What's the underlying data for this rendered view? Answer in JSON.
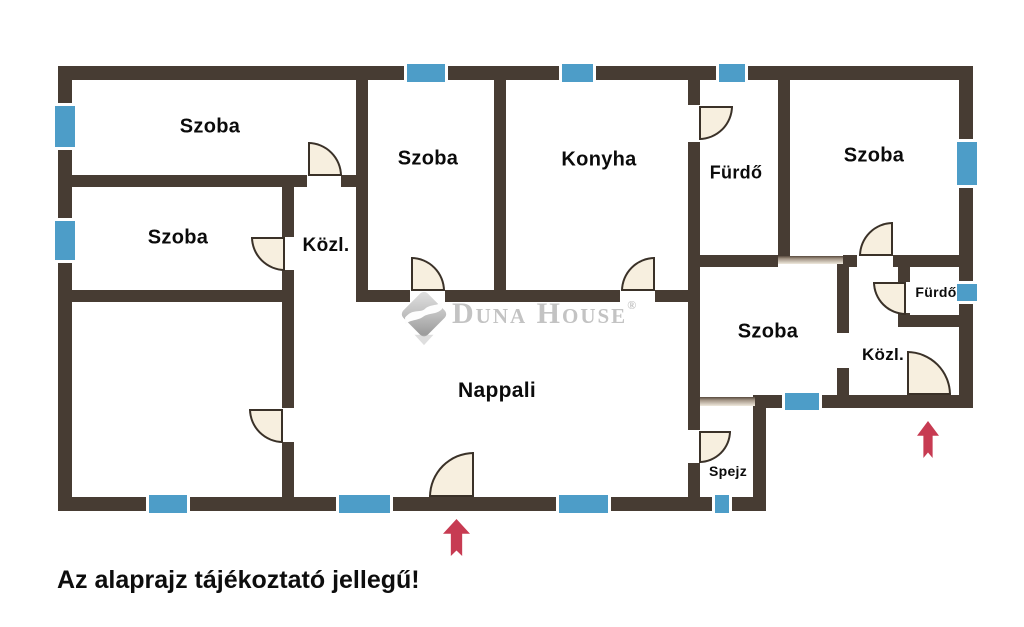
{
  "disclaimer": "Az alaprajz tájékoztató jellegű!",
  "watermark": {
    "brand": "Duna House",
    "reg": "®"
  },
  "colors": {
    "wall": "#473c33",
    "window_blue": "#4d9dc8",
    "window_frame": "#ffffff",
    "door_fill": "#f7efdf",
    "door_stroke": "#3a3128",
    "entrance_arrow": "#c73b52",
    "label_text": "#0b0b0b",
    "watermark_gray": "#c3c3c3"
  },
  "plan": {
    "rooms": [
      {
        "id": "szoba-1",
        "label": "Szoba",
        "x": 210,
        "y": 127,
        "size": 20
      },
      {
        "id": "szoba-2",
        "label": "Szoba",
        "x": 178,
        "y": 238,
        "size": 20
      },
      {
        "id": "kozl-1",
        "label": "Közl.",
        "x": 326,
        "y": 246,
        "size": 19
      },
      {
        "id": "szoba-3",
        "label": "Szoba",
        "x": 428,
        "y": 159,
        "size": 20
      },
      {
        "id": "konyha",
        "label": "Konyha",
        "x": 599,
        "y": 160,
        "size": 20
      },
      {
        "id": "furdo-1",
        "label": "Fürdő",
        "x": 736,
        "y": 173,
        "size": 18
      },
      {
        "id": "szoba-4",
        "label": "Szoba",
        "x": 874,
        "y": 156,
        "size": 20
      },
      {
        "id": "szoba-5",
        "label": "Szoba",
        "x": 768,
        "y": 332,
        "size": 20
      },
      {
        "id": "furdo-2",
        "label": "Fürdő",
        "x": 936,
        "y": 292,
        "size": 14
      },
      {
        "id": "kozl-2",
        "label": "Közl.",
        "x": 883,
        "y": 355,
        "size": 17
      },
      {
        "id": "spejz",
        "label": "Spejz",
        "x": 728,
        "y": 471,
        "size": 14
      },
      {
        "id": "nappali",
        "label": "Nappali",
        "x": 497,
        "y": 391,
        "size": 21
      }
    ],
    "walls": [
      [
        58,
        66,
        915,
        14
      ],
      [
        58,
        66,
        14,
        445
      ],
      [
        58,
        497,
        708,
        14
      ],
      [
        753,
        395,
        13,
        116
      ],
      [
        753,
        395,
        220,
        13
      ],
      [
        959,
        66,
        14,
        342
      ],
      [
        356,
        80,
        12,
        222
      ],
      [
        282,
        175,
        12,
        62
      ],
      [
        282,
        270,
        12,
        32
      ],
      [
        282,
        292,
        12,
        116
      ],
      [
        282,
        442,
        12,
        55
      ],
      [
        494,
        80,
        12,
        222
      ],
      [
        688,
        80,
        12,
        25
      ],
      [
        688,
        142,
        12,
        288
      ],
      [
        688,
        463,
        12,
        34
      ],
      [
        778,
        80,
        12,
        178
      ],
      [
        837,
        260,
        12,
        73
      ],
      [
        837,
        368,
        12,
        30
      ],
      [
        898,
        255,
        12,
        27
      ],
      [
        898,
        313,
        12,
        14
      ],
      [
        58,
        175,
        249,
        12
      ],
      [
        341,
        175,
        27,
        12
      ],
      [
        58,
        290,
        236,
        12
      ],
      [
        356,
        290,
        54,
        12
      ],
      [
        445,
        290,
        175,
        12
      ],
      [
        655,
        290,
        45,
        12
      ],
      [
        688,
        255,
        90,
        12
      ],
      [
        843,
        255,
        14,
        12
      ],
      [
        893,
        255,
        80,
        12
      ],
      [
        898,
        315,
        62,
        12
      ]
    ],
    "thresholds": [
      [
        778,
        256,
        65,
        8
      ],
      [
        700,
        397,
        55,
        9
      ]
    ],
    "windows": [
      {
        "r": [
          55,
          103,
          20,
          47
        ],
        "o": "v"
      },
      {
        "r": [
          55,
          218,
          20,
          45
        ],
        "o": "v"
      },
      {
        "r": [
          404,
          64,
          44,
          18
        ],
        "o": "h"
      },
      {
        "r": [
          559,
          64,
          37,
          18
        ],
        "o": "h"
      },
      {
        "r": [
          716,
          64,
          32,
          18
        ],
        "o": "h"
      },
      {
        "r": [
          957,
          139,
          20,
          49
        ],
        "o": "v"
      },
      {
        "r": [
          957,
          281,
          20,
          23
        ],
        "o": "v"
      },
      {
        "r": [
          146,
          495,
          44,
          18
        ],
        "o": "h"
      },
      {
        "r": [
          336,
          495,
          57,
          18
        ],
        "o": "h"
      },
      {
        "r": [
          556,
          495,
          55,
          18
        ],
        "o": "h"
      },
      {
        "r": [
          712,
          495,
          20,
          18
        ],
        "o": "h"
      },
      {
        "r": [
          782,
          393,
          40,
          17
        ],
        "o": "h"
      }
    ],
    "doors": [
      {
        "r": [
          308,
          142,
          34,
          34
        ],
        "c": "tr"
      },
      {
        "r": [
          251,
          237,
          34,
          34
        ],
        "c": "bl"
      },
      {
        "r": [
          411,
          257,
          34,
          34
        ],
        "c": "tr"
      },
      {
        "r": [
          621,
          257,
          34,
          34
        ],
        "c": "tl"
      },
      {
        "r": [
          699,
          106,
          34,
          34
        ],
        "c": "br"
      },
      {
        "r": [
          859,
          222,
          34,
          34
        ],
        "c": "tl"
      },
      {
        "r": [
          873,
          282,
          33,
          33
        ],
        "c": "bl"
      },
      {
        "r": [
          249,
          409,
          34,
          34
        ],
        "c": "bl"
      },
      {
        "r": [
          699,
          431,
          32,
          32
        ],
        "c": "br"
      },
      {
        "r": [
          429,
          452,
          45,
          45
        ],
        "c": "tl"
      },
      {
        "r": [
          907,
          351,
          44,
          44
        ],
        "c": "tr"
      }
    ],
    "arrows": [
      [
        443,
        519,
        27,
        37
      ],
      [
        917,
        421,
        22,
        37
      ]
    ]
  }
}
